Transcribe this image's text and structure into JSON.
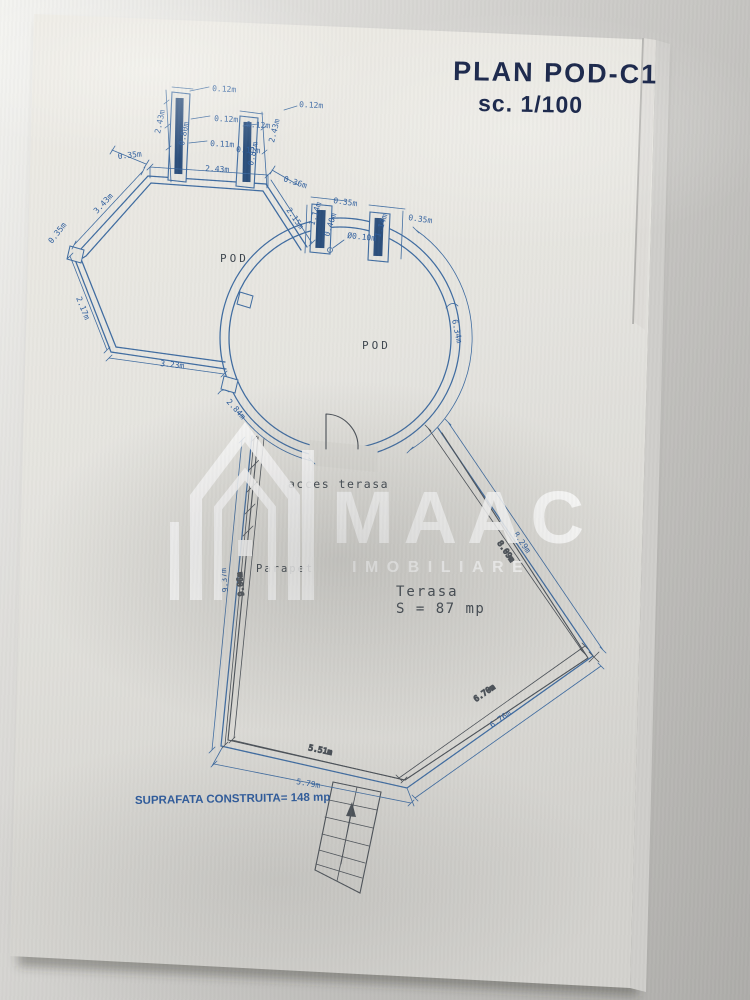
{
  "document": {
    "title_line1": "PLAN POD-C1",
    "title_line2": "sc. 1/100",
    "footer": "SUPRAFATA CONSTRUITA= 148 mp"
  },
  "plan": {
    "room1_label": "POD",
    "room2_label": "POD",
    "terrace_label": "Terasa",
    "terrace_area": "S = 87 mp",
    "access_label": "acces terasa",
    "parapet_label": "Parapet",
    "dims": [
      {
        "t": "0.12m",
        "x": 212,
        "y": 91,
        "r": 3
      },
      {
        "t": "0.12m",
        "x": 214,
        "y": 121,
        "r": 3
      },
      {
        "t": "0.11m",
        "x": 210,
        "y": 146,
        "r": 3
      },
      {
        "t": "2.43m",
        "x": 160,
        "y": 134,
        "r": -78
      },
      {
        "t": "0.80m",
        "x": 184,
        "y": 146,
        "r": -78,
        "s": 6
      },
      {
        "t": "0.12m",
        "x": 299,
        "y": 107,
        "r": 3
      },
      {
        "t": "0.12m",
        "x": 246,
        "y": 127,
        "r": 3
      },
      {
        "t": "0.11m",
        "x": 236,
        "y": 152,
        "r": 3
      },
      {
        "t": "2.43m",
        "x": 274,
        "y": 143,
        "r": -76
      },
      {
        "t": "0.82m",
        "x": 253,
        "y": 166,
        "r": -78,
        "s": 6
      },
      {
        "t": "2.43m",
        "x": 205,
        "y": 171,
        "r": 3
      },
      {
        "t": "0.35m",
        "x": 118,
        "y": 159,
        "r": -6
      },
      {
        "t": "3.43m",
        "x": 97,
        "y": 214,
        "r": -47
      },
      {
        "t": "0.35m",
        "x": 52,
        "y": 244,
        "r": -52
      },
      {
        "t": "2.17m",
        "x": 76,
        "y": 298,
        "r": 68
      },
      {
        "t": "3.23m",
        "x": 160,
        "y": 366,
        "r": 6
      },
      {
        "t": "0.36m",
        "x": 283,
        "y": 181,
        "r": 18
      },
      {
        "t": "2.15m",
        "x": 286,
        "y": 210,
        "r": 55
      },
      {
        "t": "0.35m",
        "x": 333,
        "y": 203,
        "r": 8
      },
      {
        "t": "0.35m",
        "x": 408,
        "y": 220,
        "r": 8
      },
      {
        "t": "1.14m",
        "x": 314,
        "y": 226,
        "r": -72,
        "s": 6.5
      },
      {
        "t": "0.40m",
        "x": 329,
        "y": 237,
        "r": -72,
        "s": 6
      },
      {
        "t": "Ø0.10m",
        "x": 347,
        "y": 238,
        "r": 6,
        "s": 7
      },
      {
        "t": "1.14m",
        "x": 380,
        "y": 238,
        "r": -72,
        "s": 6
      },
      {
        "t": "6.34m",
        "x": 452,
        "y": 320,
        "r": 78
      },
      {
        "t": "2.84m",
        "x": 226,
        "y": 402,
        "r": 48
      },
      {
        "t": "9.37m",
        "x": 228,
        "y": 592,
        "r": -95
      },
      {
        "t": "9.06m",
        "x": 244,
        "y": 596,
        "r": -95,
        "k": 1
      },
      {
        "t": "8.29m",
        "x": 513,
        "y": 534,
        "r": 55
      },
      {
        "t": "8.09m",
        "x": 497,
        "y": 543,
        "r": 55,
        "k": 1
      },
      {
        "t": "5.51m",
        "x": 308,
        "y": 750,
        "r": 12,
        "k": 1
      },
      {
        "t": "5.79m",
        "x": 296,
        "y": 784,
        "r": 10
      },
      {
        "t": "6.70m",
        "x": 476,
        "y": 702,
        "r": -35,
        "k": 1
      },
      {
        "t": "6.76m",
        "x": 492,
        "y": 728,
        "r": -35
      }
    ]
  },
  "watermark": {
    "brand": "MAAC",
    "subtitle": "IMOBILIARE"
  },
  "colors": {
    "ink": "#3f6ca1",
    "dark": "#4b5158",
    "dim_text": "#2f5f9e",
    "title": "#1d2a4d",
    "footer_blue": "#2d5b9e",
    "paper": "#e7e6e1"
  }
}
